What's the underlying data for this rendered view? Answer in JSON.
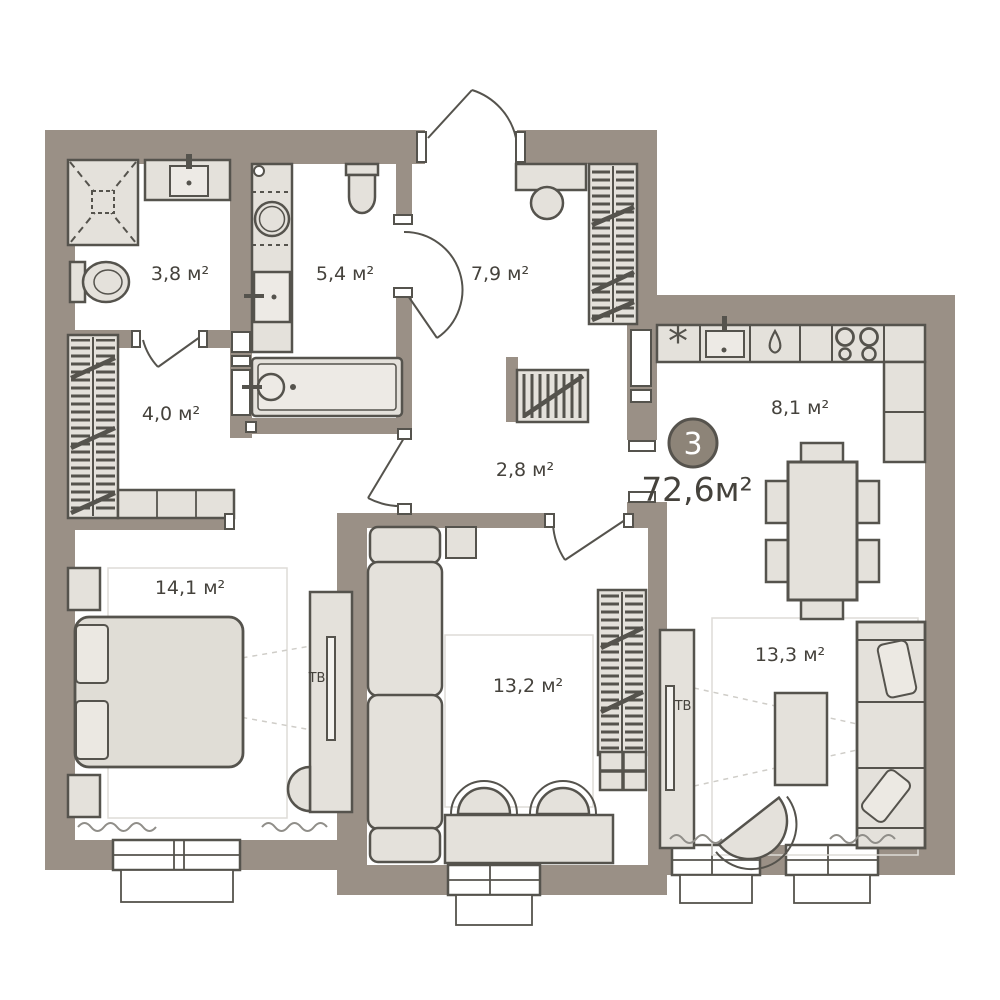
{
  "plan": {
    "badge": {
      "number": "3",
      "total_area": "72,6м²"
    },
    "rooms": [
      {
        "name": "shower-room",
        "area_label": "3,8 м²"
      },
      {
        "name": "bathroom",
        "area_label": "5,4 м²"
      },
      {
        "name": "entry-hall",
        "area_label": "7,9 м²"
      },
      {
        "name": "wardrobe-hall",
        "area_label": "4,0 м²"
      },
      {
        "name": "corridor",
        "area_label": "2,8 м²"
      },
      {
        "name": "kitchen-dining",
        "area_label": "8,1 м²"
      },
      {
        "name": "bedroom",
        "area_label": "14,1 м²"
      },
      {
        "name": "room",
        "area_label": "13,2 м²"
      },
      {
        "name": "living-room",
        "area_label": "13,3 м²"
      }
    ],
    "labels": {
      "tv_bedroom": "ТВ",
      "tv_living": "ТВ",
      "fridge_symbol": "*"
    },
    "colors": {
      "wall": "#9A9086",
      "furniture": "#E4E1DB",
      "outline": "#55534D",
      "badge_fill": "#8D8478",
      "text": "#45423C"
    }
  }
}
